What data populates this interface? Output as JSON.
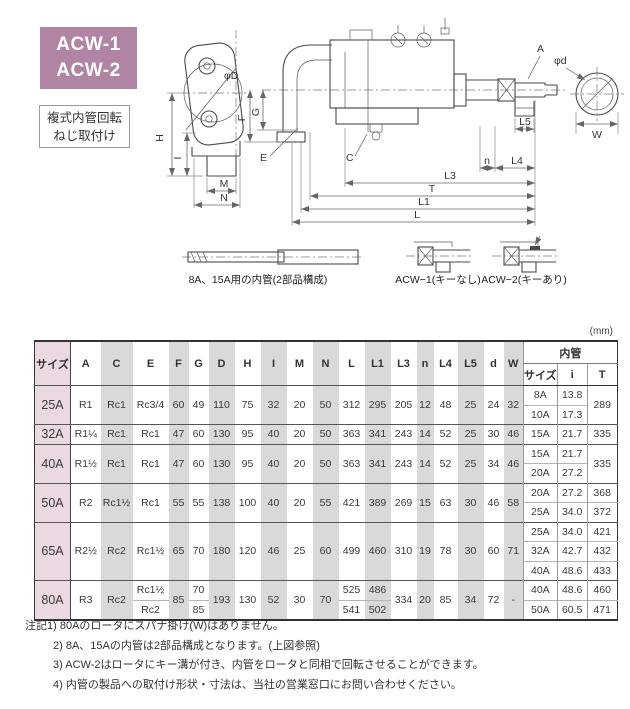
{
  "badge": {
    "line1": "ACW-1",
    "line2": "ACW-2"
  },
  "subtitle": {
    "line1": "複式内管回転",
    "line2": "ねじ取付け"
  },
  "colors": {
    "badge_bg": "#b184a3",
    "size_col_bg": "#ead9e3",
    "stripe_gray": "#d9d9d9"
  },
  "drawing": {
    "labels": {
      "phiD": "φD",
      "phid": "φd",
      "A": "A",
      "W": "W",
      "H": "H",
      "I": "I",
      "M": "M",
      "N": "N",
      "F": "F",
      "G": "G",
      "E": "E",
      "C": "C",
      "L5": "L5",
      "n": "n",
      "L4": "L4",
      "L3": "L3",
      "T": "T",
      "L1": "L1",
      "L": "L"
    },
    "captions": {
      "inner_tube": "8A、15A用の内管(2部品構成)",
      "acw1": "ACW−1(キーなし)",
      "acw2": "ACW−2(キーあり)"
    }
  },
  "table": {
    "unit_label": "(mm)",
    "header_rows": [
      [
        {
          "t": "サイズ",
          "rs": 2,
          "c": "hsize"
        },
        {
          "t": "A",
          "rs": 2
        },
        {
          "t": "C",
          "rs": 2,
          "c": "g"
        },
        {
          "t": "E",
          "rs": 2
        },
        {
          "t": "F",
          "rs": 2,
          "c": "g"
        },
        {
          "t": "G",
          "rs": 2
        },
        {
          "t": "D",
          "rs": 2,
          "c": "g"
        },
        {
          "t": "H",
          "rs": 2
        },
        {
          "t": "I",
          "rs": 2,
          "c": "g"
        },
        {
          "t": "M",
          "rs": 2
        },
        {
          "t": "N",
          "rs": 2,
          "c": "g"
        },
        {
          "t": "L",
          "rs": 2
        },
        {
          "t": "L1",
          "rs": 2,
          "c": "g"
        },
        {
          "t": "L3",
          "rs": 2
        },
        {
          "t": "n",
          "rs": 2,
          "c": "g"
        },
        {
          "t": "L4",
          "rs": 2
        },
        {
          "t": "L5",
          "rs": 2,
          "c": "g"
        },
        {
          "t": "d",
          "rs": 2
        },
        {
          "t": "W",
          "rs": 2,
          "c": "g"
        },
        {
          "t": "内管",
          "cs": 3,
          "c": "ihead"
        }
      ],
      [
        {
          "t": "サイズ",
          "c": "isub"
        },
        {
          "t": "i",
          "c": "isub"
        },
        {
          "t": "T",
          "c": "isub"
        }
      ]
    ],
    "body_rows": [
      {
        "start": true,
        "cells": [
          {
            "t": "25A",
            "rs": 2,
            "c": "size"
          },
          {
            "t": "R1",
            "rs": 2
          },
          {
            "t": "Rc1",
            "rs": 2,
            "c": "g"
          },
          {
            "t": "Rc3/4",
            "rs": 2
          },
          {
            "t": "60",
            "rs": 2,
            "c": "g"
          },
          {
            "t": "49",
            "rs": 2
          },
          {
            "t": "110",
            "rs": 2,
            "c": "g"
          },
          {
            "t": "75",
            "rs": 2
          },
          {
            "t": "32",
            "rs": 2,
            "c": "g"
          },
          {
            "t": "20",
            "rs": 2
          },
          {
            "t": "50",
            "rs": 2,
            "c": "g"
          },
          {
            "t": "312",
            "rs": 2
          },
          {
            "t": "295",
            "rs": 2,
            "c": "g"
          },
          {
            "t": "205",
            "rs": 2
          },
          {
            "t": "12",
            "rs": 2,
            "c": "g"
          },
          {
            "t": "48",
            "rs": 2
          },
          {
            "t": "25",
            "rs": 2,
            "c": "g"
          },
          {
            "t": "24",
            "rs": 2
          },
          {
            "t": "32",
            "rs": 2,
            "c": "g"
          },
          {
            "t": "8A",
            "c": "iv"
          },
          {
            "t": "13.8",
            "c": "iv"
          },
          {
            "t": "289",
            "rs": 2,
            "c": "iv"
          }
        ]
      },
      {
        "start": false,
        "cells": [
          {
            "t": "10A",
            "c": "iv"
          },
          {
            "t": "17.3",
            "c": "iv"
          }
        ]
      },
      {
        "start": true,
        "cells": [
          {
            "t": "32A",
            "c": "size"
          },
          {
            "t": "R1¼"
          },
          {
            "t": "Rc1",
            "c": "g"
          },
          {
            "t": "Rc1"
          },
          {
            "t": "47",
            "c": "g"
          },
          {
            "t": "60"
          },
          {
            "t": "130",
            "c": "g"
          },
          {
            "t": "95"
          },
          {
            "t": "40",
            "c": "g"
          },
          {
            "t": "20"
          },
          {
            "t": "50",
            "c": "g"
          },
          {
            "t": "363"
          },
          {
            "t": "341",
            "c": "g"
          },
          {
            "t": "243"
          },
          {
            "t": "14",
            "c": "g"
          },
          {
            "t": "52"
          },
          {
            "t": "25",
            "c": "g"
          },
          {
            "t": "30"
          },
          {
            "t": "46",
            "c": "g"
          },
          {
            "t": "15A",
            "c": "iv"
          },
          {
            "t": "21.7",
            "c": "iv"
          },
          {
            "t": "335",
            "c": "iv"
          }
        ]
      },
      {
        "start": true,
        "cells": [
          {
            "t": "40A",
            "rs": 2,
            "c": "size"
          },
          {
            "t": "R1½",
            "rs": 2
          },
          {
            "t": "Rc1",
            "rs": 2,
            "c": "g"
          },
          {
            "t": "Rc1",
            "rs": 2
          },
          {
            "t": "47",
            "rs": 2,
            "c": "g"
          },
          {
            "t": "60",
            "rs": 2
          },
          {
            "t": "130",
            "rs": 2,
            "c": "g"
          },
          {
            "t": "95",
            "rs": 2
          },
          {
            "t": "40",
            "rs": 2,
            "c": "g"
          },
          {
            "t": "20",
            "rs": 2
          },
          {
            "t": "50",
            "rs": 2,
            "c": "g"
          },
          {
            "t": "363",
            "rs": 2
          },
          {
            "t": "341",
            "rs": 2,
            "c": "g"
          },
          {
            "t": "243",
            "rs": 2
          },
          {
            "t": "14",
            "rs": 2,
            "c": "g"
          },
          {
            "t": "52",
            "rs": 2
          },
          {
            "t": "25",
            "rs": 2,
            "c": "g"
          },
          {
            "t": "34",
            "rs": 2
          },
          {
            "t": "46",
            "rs": 2,
            "c": "g"
          },
          {
            "t": "15A",
            "c": "iv"
          },
          {
            "t": "21.7",
            "c": "iv"
          },
          {
            "t": "335",
            "rs": 2,
            "c": "iv"
          }
        ]
      },
      {
        "start": false,
        "cells": [
          {
            "t": "20A",
            "c": "iv"
          },
          {
            "t": "27.2",
            "c": "iv"
          }
        ]
      },
      {
        "start": true,
        "cells": [
          {
            "t": "50A",
            "rs": 2,
            "c": "size"
          },
          {
            "t": "R2",
            "rs": 2
          },
          {
            "t": "Rc1½",
            "rs": 2,
            "c": "g"
          },
          {
            "t": "Rc1",
            "rs": 2
          },
          {
            "t": "55",
            "rs": 2,
            "c": "g"
          },
          {
            "t": "55",
            "rs": 2
          },
          {
            "t": "138",
            "rs": 2,
            "c": "g"
          },
          {
            "t": "100",
            "rs": 2
          },
          {
            "t": "40",
            "rs": 2,
            "c": "g"
          },
          {
            "t": "20",
            "rs": 2
          },
          {
            "t": "55",
            "rs": 2,
            "c": "g"
          },
          {
            "t": "421",
            "rs": 2
          },
          {
            "t": "389",
            "rs": 2,
            "c": "g"
          },
          {
            "t": "269",
            "rs": 2
          },
          {
            "t": "15",
            "rs": 2,
            "c": "g"
          },
          {
            "t": "63",
            "rs": 2
          },
          {
            "t": "30",
            "rs": 2,
            "c": "g"
          },
          {
            "t": "46",
            "rs": 2
          },
          {
            "t": "58",
            "rs": 2,
            "c": "g"
          },
          {
            "t": "20A",
            "c": "iv"
          },
          {
            "t": "27.2",
            "c": "iv"
          },
          {
            "t": "368",
            "c": "iv"
          }
        ]
      },
      {
        "start": false,
        "cells": [
          {
            "t": "25A",
            "c": "iv"
          },
          {
            "t": "34.0",
            "c": "iv"
          },
          {
            "t": "372",
            "c": "iv"
          }
        ]
      },
      {
        "start": true,
        "cells": [
          {
            "t": "65A",
            "rs": 3,
            "c": "size"
          },
          {
            "t": "R2½",
            "rs": 3
          },
          {
            "t": "Rc2",
            "rs": 3,
            "c": "g"
          },
          {
            "t": "Rc1½",
            "rs": 3
          },
          {
            "t": "65",
            "rs": 3,
            "c": "g"
          },
          {
            "t": "70",
            "rs": 3
          },
          {
            "t": "180",
            "rs": 3,
            "c": "g"
          },
          {
            "t": "120",
            "rs": 3
          },
          {
            "t": "46",
            "rs": 3,
            "c": "g"
          },
          {
            "t": "25",
            "rs": 3
          },
          {
            "t": "60",
            "rs": 3,
            "c": "g"
          },
          {
            "t": "499",
            "rs": 3
          },
          {
            "t": "460",
            "rs": 3,
            "c": "g"
          },
          {
            "t": "310",
            "rs": 3
          },
          {
            "t": "19",
            "rs": 3,
            "c": "g"
          },
          {
            "t": "78",
            "rs": 3
          },
          {
            "t": "30",
            "rs": 3,
            "c": "g"
          },
          {
            "t": "60",
            "rs": 3
          },
          {
            "t": "71",
            "rs": 3,
            "c": "g"
          },
          {
            "t": "25A",
            "c": "iv"
          },
          {
            "t": "34.0",
            "c": "iv"
          },
          {
            "t": "421",
            "c": "iv"
          }
        ]
      },
      {
        "start": false,
        "cells": [
          {
            "t": "32A",
            "c": "iv"
          },
          {
            "t": "42.7",
            "c": "iv"
          },
          {
            "t": "432",
            "c": "iv"
          }
        ]
      },
      {
        "start": false,
        "cells": [
          {
            "t": "40A",
            "c": "iv"
          },
          {
            "t": "48.6",
            "c": "iv"
          },
          {
            "t": "433",
            "c": "iv"
          }
        ]
      },
      {
        "start": true,
        "cells": [
          {
            "t": "80A",
            "rs": 2,
            "c": "size"
          },
          {
            "t": "R3",
            "rs": 2
          },
          {
            "t": "Rc2",
            "rs": 2,
            "c": "g"
          },
          {
            "t": "Rc1½"
          },
          {
            "t": "85",
            "rs": 2,
            "c": "g"
          },
          {
            "t": "70"
          },
          {
            "t": "193",
            "rs": 2,
            "c": "g"
          },
          {
            "t": "130",
            "rs": 2
          },
          {
            "t": "52",
            "rs": 2,
            "c": "g"
          },
          {
            "t": "30",
            "rs": 2
          },
          {
            "t": "70",
            "rs": 2,
            "c": "g"
          },
          {
            "t": "525"
          },
          {
            "t": "486",
            "c": "g"
          },
          {
            "t": "334",
            "rs": 2
          },
          {
            "t": "20",
            "rs": 2,
            "c": "g"
          },
          {
            "t": "85",
            "rs": 2
          },
          {
            "t": "34",
            "rs": 2,
            "c": "g"
          },
          {
            "t": "72",
            "rs": 2
          },
          {
            "t": "-",
            "rs": 2,
            "c": "g"
          },
          {
            "t": "40A",
            "c": "iv"
          },
          {
            "t": "48.6",
            "c": "iv"
          },
          {
            "t": "460",
            "c": "iv"
          }
        ]
      },
      {
        "start": false,
        "cells": [
          {
            "t": "Rc2"
          },
          {
            "t": "85"
          },
          {
            "t": "541"
          },
          {
            "t": "502",
            "c": "g"
          },
          {
            "t": "50A",
            "c": "iv"
          },
          {
            "t": "60.5",
            "c": "iv"
          },
          {
            "t": "471",
            "c": "iv"
          }
        ]
      }
    ]
  },
  "notes": [
    "注記1) 80Aのロータにスパナ掛け(W)はありません。",
    "2) 8A、15Aの内管は2部品構成となります。(上図参照)",
    "3) ACW-2はロータにキー溝が付き、内管をロータと同相で回転させることができます。",
    "4) 内管の製品への取付け形状・寸法は、当社の営業窓口にお問い合わせください。"
  ]
}
